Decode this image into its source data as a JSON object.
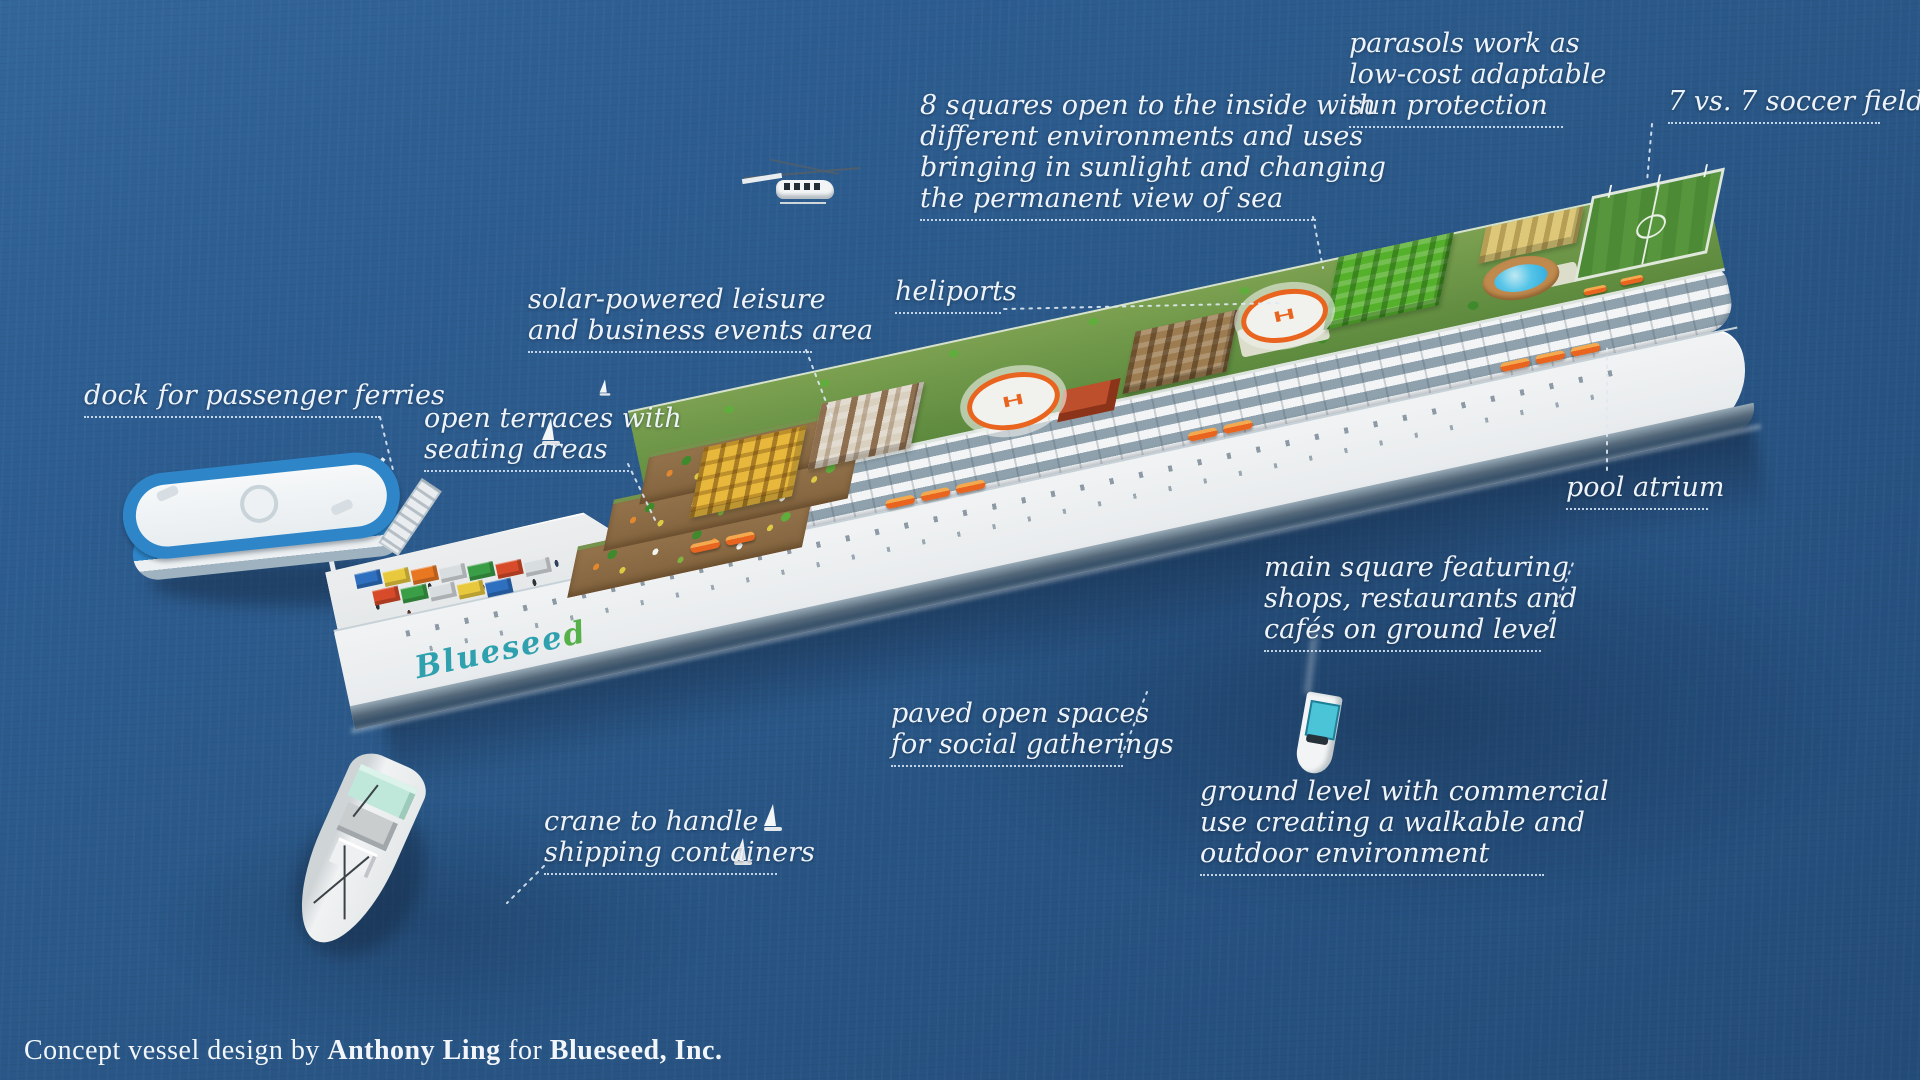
{
  "title": "Blueseed concept vessel annotated rendering",
  "colors": {
    "ocean_top": "#336699",
    "ocean_bottom": "#244c78",
    "label_text": "#edf3f9",
    "roof_green": "#6a9a4a",
    "lifeboat_orange": "#e8641f",
    "helipad_orange": "#e8641f",
    "pool_blue": "#2fa9dc",
    "ferry_blue": "#2e86c9",
    "logo_teal": "#2fa0ae",
    "logo_green": "#57b14b"
  },
  "labels": {
    "parasols": {
      "lines": [
        "parasols work as",
        "low-cost adaptable",
        "sun protection"
      ]
    },
    "soccer": {
      "lines": [
        "7 vs. 7 soccer field"
      ]
    },
    "squares": {
      "lines": [
        "8 squares open to the inside with",
        "different environments and uses",
        "bringing in sunlight and changing",
        "the permanent view of sea"
      ]
    },
    "heliports": {
      "lines": [
        "heliports"
      ]
    },
    "solar": {
      "lines": [
        "solar-powered leisure",
        "and business events area"
      ]
    },
    "dock": {
      "lines": [
        "dock for passenger ferries"
      ]
    },
    "terraces": {
      "lines": [
        "open terraces with",
        "seating areas"
      ]
    },
    "pool": {
      "lines": [
        "pool atrium"
      ]
    },
    "mainsquare": {
      "lines": [
        "main square featuring",
        "shops, restaurants and",
        "cafés on ground level"
      ]
    },
    "paved": {
      "lines": [
        "paved open spaces",
        "for social gatherings"
      ]
    },
    "ground": {
      "lines": [
        "ground level with commercial",
        "use creating a walkable and",
        "outdoor environment"
      ]
    },
    "crane": {
      "lines": [
        "crane to handle",
        "shipping containers"
      ]
    }
  },
  "ship": {
    "hull_logo_main": "Bluesee",
    "hull_logo_accent": "d",
    "helipad_mark": "H"
  },
  "credit": {
    "prefix": "Concept vessel design by ",
    "author": "Anthony Ling",
    "connector": " for ",
    "company": "Blueseed, Inc."
  }
}
